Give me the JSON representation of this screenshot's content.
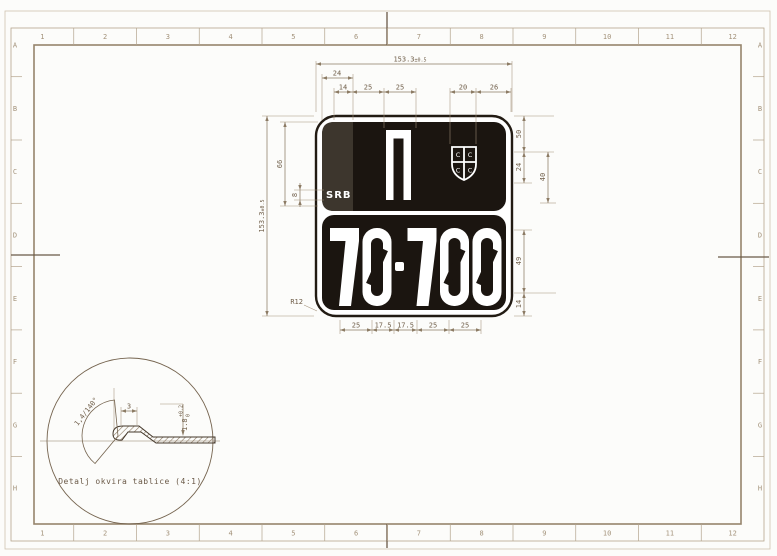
{
  "sheet": {
    "grid_columns": [
      "1",
      "2",
      "3",
      "4",
      "5",
      "6",
      "7",
      "8",
      "9",
      "10",
      "11",
      "12"
    ],
    "grid_rows": [
      "A",
      "B",
      "C",
      "D",
      "E",
      "F",
      "G",
      "H"
    ]
  },
  "plate": {
    "country_code": "SRB",
    "letter": "П",
    "registration_number": "70-700",
    "emblem": "serbian-cross-shield",
    "firesteel_glyph": "С",
    "colors": {
      "plate_black": "#1b1510",
      "strip_gray": "#3d362d",
      "white": "#ffffff"
    }
  },
  "dimensions": {
    "width": "153.3",
    "width_tol": "±0.5",
    "height": "153.3",
    "height_tol": "±0.5",
    "strip": "24",
    "top": [
      "14",
      "25",
      "25",
      "20",
      "26"
    ],
    "letter_height": "66",
    "srb_height": "8",
    "right": [
      "50",
      "24",
      "40",
      "49",
      "14"
    ],
    "digit_widths": [
      "25",
      "17.5",
      "17.5",
      "25",
      "25"
    ],
    "radius": "R12"
  },
  "detail": {
    "caption": "Detalj okvira tablice (4:1)",
    "angle_label": "1,4/140°",
    "flat_width": "3",
    "thickness": "1.8",
    "thickness_tol_upper": "+0.2",
    "thickness_tol_lower": "0"
  }
}
